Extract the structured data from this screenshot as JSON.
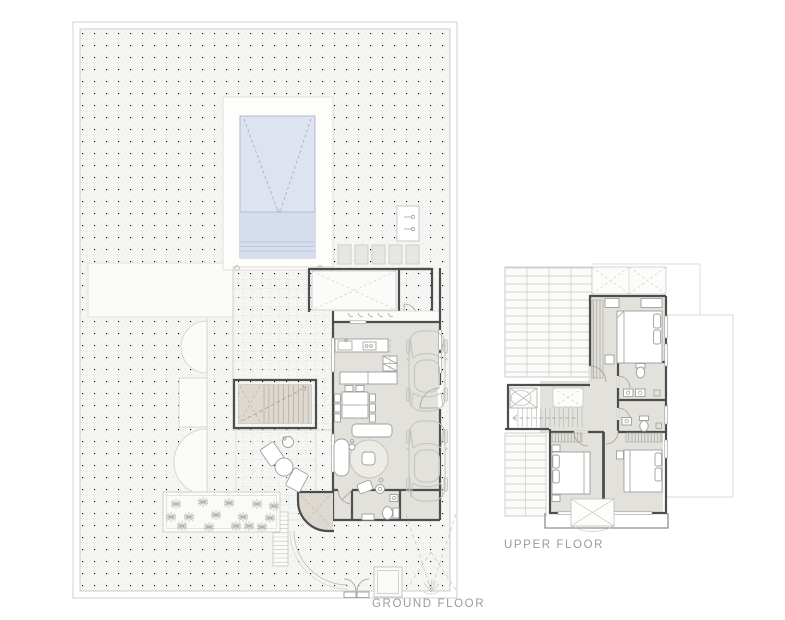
{
  "sheet": {
    "labels": {
      "ground_floor": "GROUND FLOOR",
      "upper_floor": "UPPER FLOOR"
    }
  },
  "colors": {
    "wall": "#4d4d4d",
    "thin_line": "#c2c2bf",
    "interior_floor": "#e3e1db",
    "stair_fill": "#ddd8d0",
    "pool_water": "#dde4f0",
    "pool_line": "#a9b4ca",
    "site_fill": "#f5f5f3",
    "grid_line": "#d8d6d1",
    "furniture_line": "#9e9e9a",
    "label_text": "#9b9b9b"
  }
}
